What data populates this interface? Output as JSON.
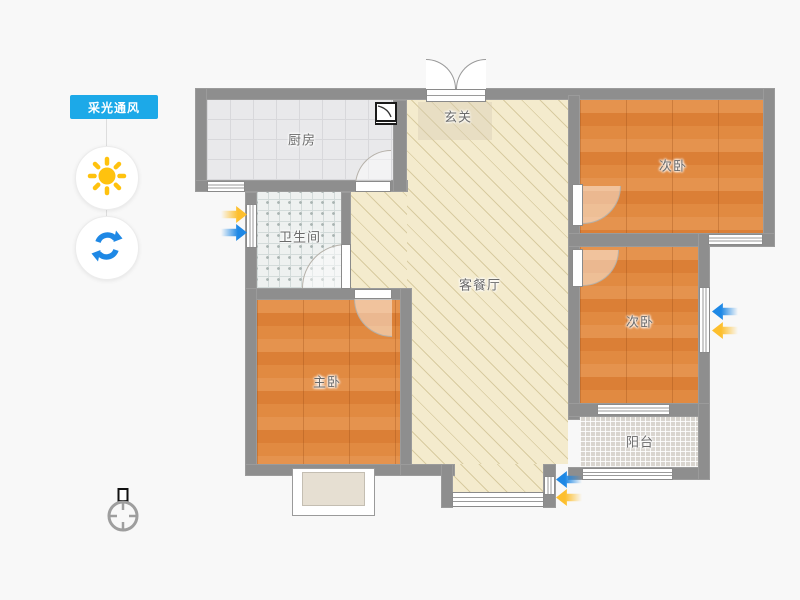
{
  "sidebar": {
    "mode_button": "采光通风",
    "icons": [
      "sun-icon",
      "refresh-icon"
    ]
  },
  "rooms": {
    "kitchen": "厨房",
    "entry": "玄关",
    "bedroom_top": "次卧",
    "bedroom_mid": "次卧",
    "bathroom": "卫生间",
    "living_dining": "客餐厅",
    "master": "主卧",
    "balcony": "阳台"
  },
  "indicators": {
    "lighting_arrow_color": "#fdbf2d",
    "ventilation_arrow_color": "#1e88e5"
  },
  "colors": {
    "accent": "#1ca9e8",
    "sun": "#ffc20e",
    "wall": "#8e8e8e",
    "wood_floor": "#e08a42",
    "living_floor": "#f4ebcd"
  }
}
